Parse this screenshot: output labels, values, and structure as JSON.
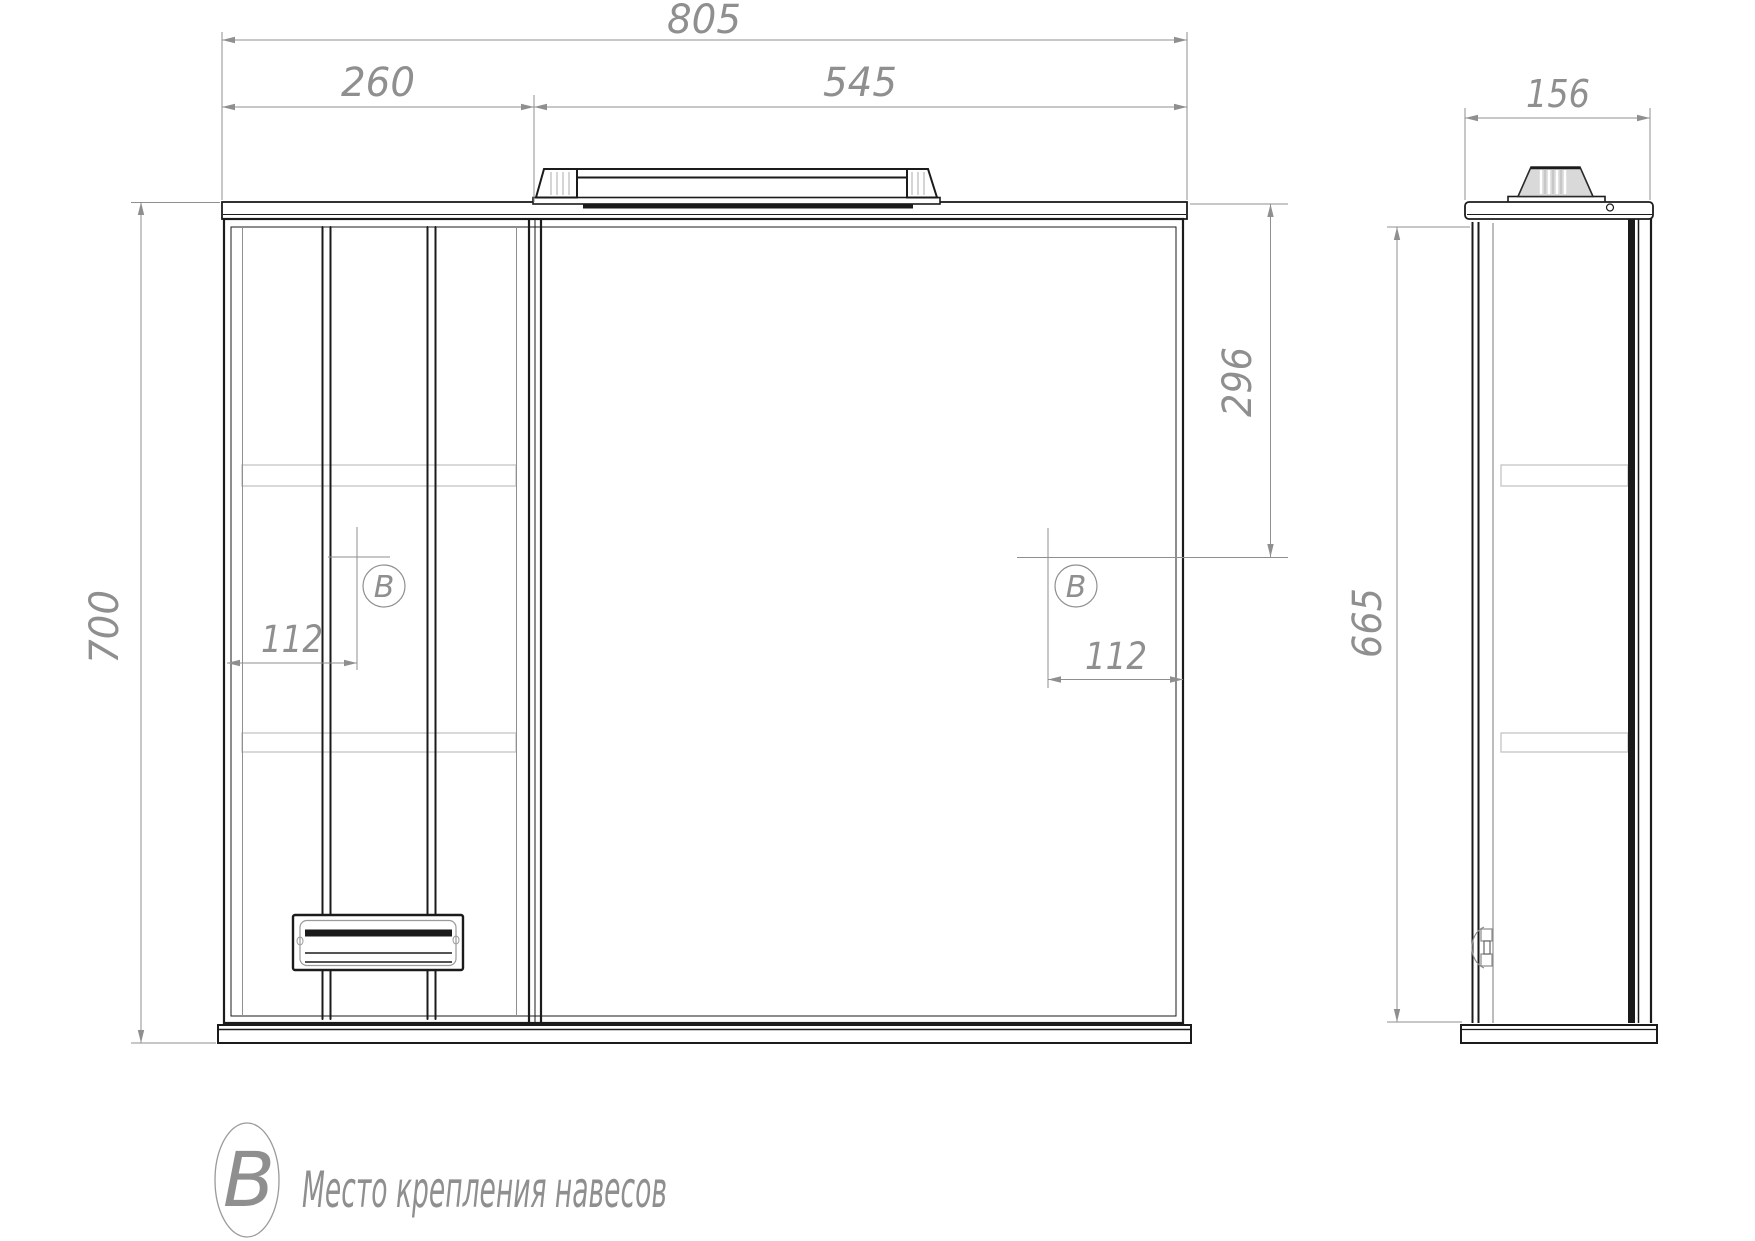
{
  "front_view": {
    "width_total": "805",
    "width_left_cabinet": "260",
    "width_mirror": "545",
    "height_total": "700",
    "mount_offset_from_top": "296",
    "mount_offset_from_left": "112",
    "mount_offset_from_right": "112",
    "marker_letter": "B"
  },
  "side_view": {
    "depth": "156",
    "body_height": "665"
  },
  "legend": {
    "marker_letter": "B",
    "label": "Место крепления навесов"
  },
  "colors": {
    "object_line": "#1b1b1b",
    "dimension_line": "#8f8f8f",
    "shelf_line": "#c9c9c9",
    "lamp_side_fill": "#d9d9d9",
    "background": "#ffffff"
  }
}
